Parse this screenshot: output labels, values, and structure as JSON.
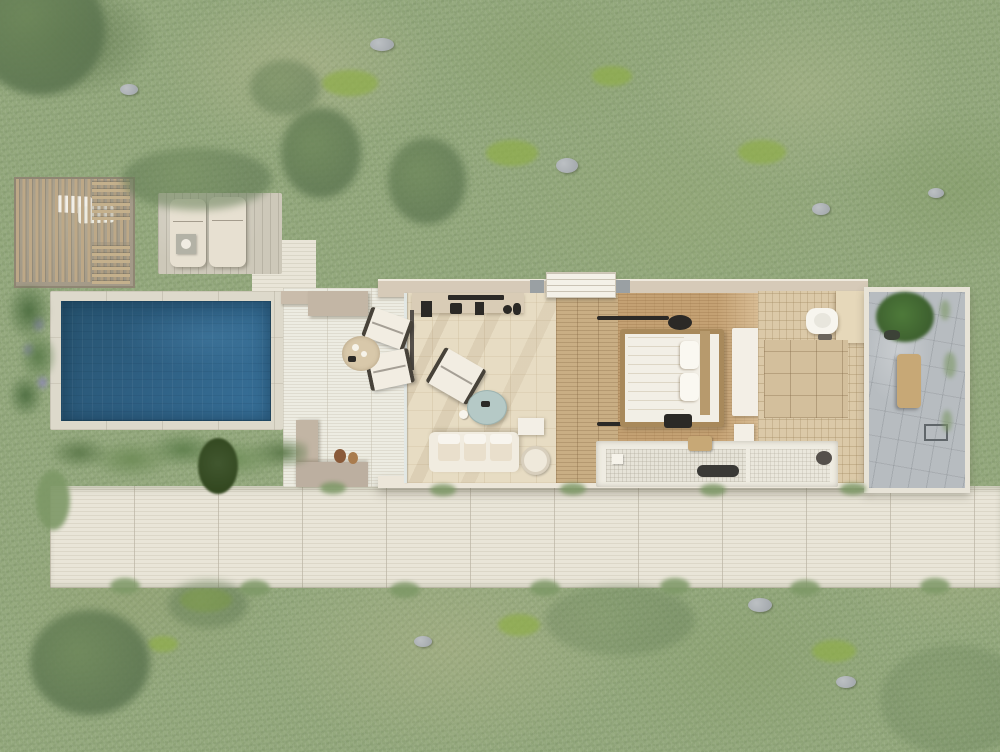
{
  "scene": {
    "label": "villa-suite-pool-aerial-render",
    "view": "top-down",
    "regions": {
      "garden": "mediterranean scrub lawn with moss patches and rocks",
      "pergola": "slatted timber pergola with two loungers",
      "sun_deck": "timber sun deck with two sun loungers and side table",
      "pool": "rectangular swimming pool with stone coping",
      "terrace": "stone terrace with two folding chairs, round rug and L-shaped benches",
      "living_room": "living room with kitchenette console, armchair, round coffee table and sofa",
      "hallway": "timber-floor entry hall with stepped entrance threshold",
      "bedroom": "bedroom with timber-frame double bed, pillows, light tracks, pouf and foot bench",
      "wardrobe": "white wardrobe panel beside bedroom",
      "bath_zone": "sunken white-tiled bathtub zone with stool and tray",
      "bathroom": "beige-tiled bathroom with toilet and shelving closet",
      "courtyard": "stone outdoor-shower courtyard with bush, bench and shower fixture",
      "walkway": "white stone walkway across the bottom"
    },
    "colors": {
      "grass_base": "#93a87c",
      "grass_dry": "#b8bb93",
      "moss": "#8fae4a",
      "tree_olive": "#5c7550",
      "rock_grey": "#a6abaf",
      "stone_light": "#e9e5d8",
      "stone_seam": "#b9b2a0",
      "deck_wood": "#cdc8b9",
      "pergola_wood": "#bda887",
      "pool_coping": "#ddd9cb",
      "pool_water_dark": "#27536f",
      "pool_water_mid": "#2e5f82",
      "pool_water_light": "#38719a",
      "wall_cream": "#efeae0",
      "wall_taupe": "#d6cab8",
      "living_floor": "#e7dcc3",
      "wood_floor": "#c9ae84",
      "woven_floor": "#c4a173",
      "bed_frame": "#a8895b",
      "linen_white": "#f2efe6",
      "bath_tile": "#dbc9a8",
      "wet_tile": "#efece2",
      "courtyard_stone": "#b7bcc0",
      "bench_wood": "#c7a876",
      "coffee_table_blue": "#b5c9c6",
      "sofa_cream": "#f1ece0",
      "dark_accent": "#2b2926",
      "lavender": "#8d87b8"
    }
  }
}
